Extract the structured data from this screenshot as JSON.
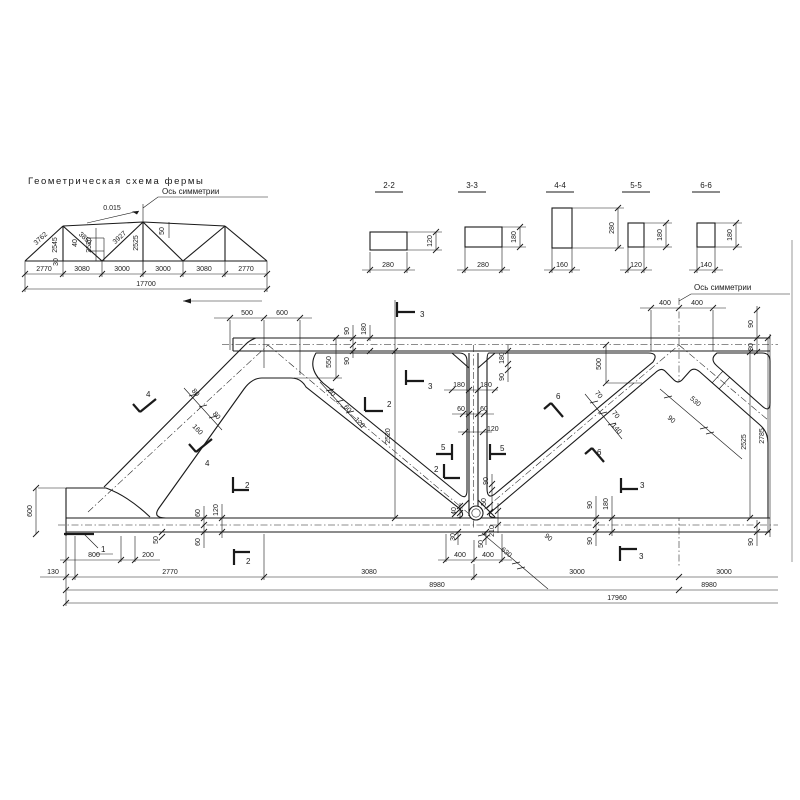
{
  "scheme": {
    "title": "Геометрическая схема фермы",
    "axis_label": "Ось симметрии",
    "slope": "0.015",
    "diag1": "3762",
    "vert1": "2545",
    "diag2": "3851",
    "vert2": "2520",
    "diag3": "3927",
    "vert3": "2525",
    "e40": "40",
    "e30": "30",
    "e50": "50",
    "spans": [
      "2770",
      "3080",
      "3000",
      "3000",
      "3080",
      "2770"
    ],
    "total": "17700"
  },
  "sections": [
    {
      "label": "2-2",
      "width": "280",
      "height": "120"
    },
    {
      "label": "3-3",
      "width": "280",
      "height": "180"
    },
    {
      "label": "4-4",
      "width": "160",
      "height": "280"
    },
    {
      "label": "5-5",
      "width": "120",
      "height": "180"
    },
    {
      "label": "6-6",
      "width": "140",
      "height": "180"
    }
  ],
  "main": {
    "axis_label": "Ось симметрии",
    "marks": {
      "n1": "1",
      "s2": "2",
      "s3": "3",
      "s4": "4",
      "s5": "5",
      "s6": "6"
    },
    "top": {
      "d500": "500",
      "d600": "600",
      "d400a": "400",
      "d400b": "400",
      "r90": "90",
      "r80": "80"
    },
    "left": {
      "h600": "600",
      "d130": "130",
      "d800": "800",
      "d200": "200",
      "p50": "50"
    },
    "top_chord": {
      "a90": "90",
      "a180": "180",
      "b90": "90",
      "g550": "550"
    },
    "end_diag": {
      "w80a": "80",
      "w80b": "80",
      "w160": "160"
    },
    "diag1": {
      "w60a": "60",
      "w60b": "60",
      "w120": "120",
      "h2520": "2520"
    },
    "vert": {
      "g180a": "180",
      "g180b": "180",
      "r180": "180",
      "r90": "90",
      "w60a": "60",
      "w60b": "60",
      "w120": "120",
      "b90": "90",
      "b50": "50"
    },
    "node2": {
      "e40": "40",
      "e30": "30",
      "e50a": "50",
      "e210": "210",
      "e50b": "50",
      "d400a": "400",
      "d400b": "400",
      "d630": "630",
      "d90": "90"
    },
    "chord_left": {
      "a60": "60",
      "t120": "120",
      "b60": "60"
    },
    "chord_right": {
      "a90": "90",
      "t180": "180",
      "b90": "90",
      "edge90": "90"
    },
    "diag2": {
      "w70a": "70",
      "w70b": "70",
      "w140": "140"
    },
    "diag3": {
      "d530": "530",
      "d90": "90",
      "g500": "500"
    },
    "heights": {
      "h2525": "2525",
      "h2785": "2785"
    },
    "rows": {
      "d2770": "2770",
      "d3080": "3080",
      "d3000a": "3000",
      "d3000b": "3000",
      "d8980a": "8980",
      "d8980b": "8980",
      "d17960": "17960"
    }
  }
}
